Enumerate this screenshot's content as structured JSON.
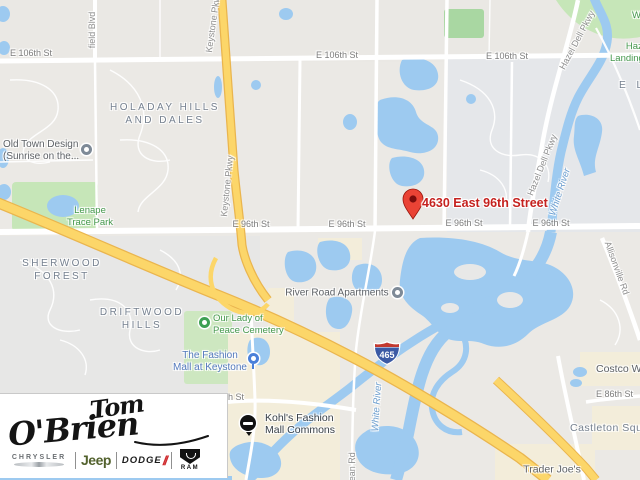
{
  "map": {
    "address_label": "4630 East 96th Street",
    "interstate_shield": "465",
    "streets": [
      "E 106th St",
      "E 106th St",
      "E 106th St",
      "E 96th St",
      "E 96th St",
      "E 96th St",
      "E 96th St",
      "E 86th St",
      "h St"
    ],
    "roads_rotated": [
      "Keystone Pkwy",
      "Keystone Pkwy",
      "Hazel Dell Pkwy",
      "Hazel Dell Pkwy",
      "Allisonville Rd",
      "field Blvd",
      "Dean Rd"
    ],
    "water_labels": [
      "White River",
      "White River"
    ],
    "neighborhoods": [
      {
        "line1": "HOLADAY HILLS",
        "line2": "AND DALES"
      },
      {
        "line1": "SHERWOOD",
        "line2": "FOREST"
      },
      {
        "line1": "DRIFTWOOD",
        "line2": "HILLS"
      },
      {
        "line1": "E L",
        "line2": ""
      }
    ],
    "parks": [
      {
        "line1": "Lenape",
        "line2": "Trace Park"
      },
      {
        "line1": "Hazel",
        "line2": "Landing Park"
      },
      {
        "line1": "Our Lady of",
        "line2": "Peace Cemetery"
      },
      {
        "line1": "W",
        "line2": ""
      }
    ],
    "pois": [
      {
        "line1": "Old Town Design",
        "line2": "(Sunrise on the..."
      },
      {
        "line1": "River Road Apartments",
        "line2": ""
      },
      {
        "line1": "The Fashion",
        "line2": "Mall at Keystone"
      },
      {
        "line1": "Kohl's Fashion",
        "line2": "Mall Commons"
      },
      {
        "line1": "Trader Joe's",
        "line2": ""
      },
      {
        "line1": "Costco Wholesale",
        "line2": ""
      },
      {
        "line1": "Castleton Square",
        "line2": ""
      }
    ]
  },
  "logo": {
    "dealer_name_top": "Tom",
    "dealer_name_bottom": "O'Brien",
    "brands": [
      "CHRYSLER",
      "Jeep",
      "DODGE",
      "RAM"
    ]
  },
  "colors": {
    "water": "#9dcaf0",
    "park": "#c6e6b8",
    "highway": "#fcd669",
    "commercial": "#f3edda",
    "address_red": "#c5221f"
  }
}
